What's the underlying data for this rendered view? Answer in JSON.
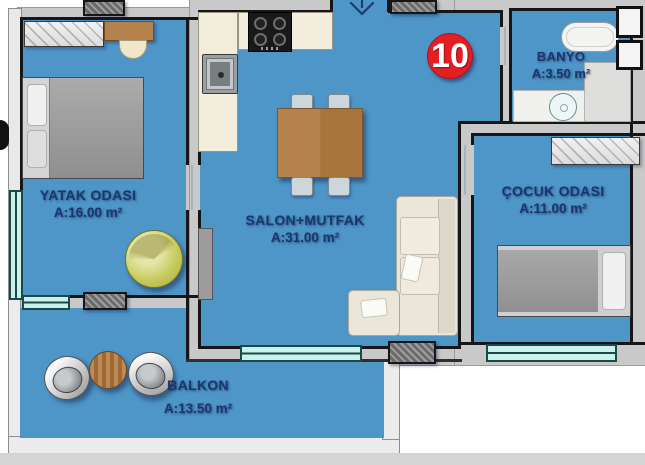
{
  "plan": {
    "title": "apartment floor plan",
    "unit_number": "10",
    "rooms": [
      {
        "name": "YATAK ODASI",
        "area": "A:16.00 m²"
      },
      {
        "name": "SALON+MUTFAK",
        "area": "A:31.00 m²"
      },
      {
        "name": "BANYO",
        "area": "A:3.50 m²"
      },
      {
        "name": "ÇOCUK ODASI",
        "area": "A:11.00 m²"
      },
      {
        "name": "BALKON",
        "area": "A:13.50 m²"
      }
    ],
    "icons": {
      "entrance_arrow": "down-arrow"
    },
    "colors": {
      "floor": "#4e95c8",
      "wall_fill": "#c9c9c9",
      "wall_line": "#161616",
      "window": "#c9f2ee",
      "label_text": "#1b3570",
      "badge": "#e31e25",
      "counter": "#f3eedb",
      "wood": "#b5824d"
    }
  }
}
